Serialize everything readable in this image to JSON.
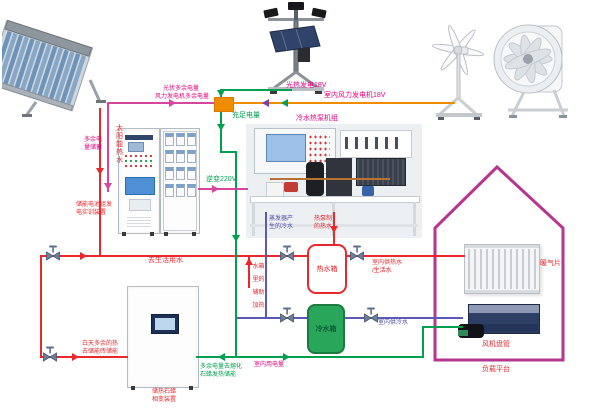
{
  "colors": {
    "pipe_hot": "#e8282d",
    "pipe_cold": "#5a5ab4",
    "wire_green": "#00a050",
    "wire_orange": "#f08c00",
    "wire_magenta": "#d6459e",
    "house_outline": "#b5358f",
    "tank_cold_fill": "#2aa65a"
  },
  "labels": {
    "solar_hot_water": "太阳能热水",
    "pv_generation": "光热发电18V",
    "indoor_wind_generation": "室内风力发电机18V",
    "pv_surplus": "光伏多余电量",
    "wind_surplus": "风力发电机多余电量",
    "surplus_storage": [
      "多余电",
      "量储蓄"
    ],
    "sufficient_power": "充足电量",
    "inverter_220v": "逆变220V",
    "battery_training_device": [
      "储能电池组发",
      "电实训装置"
    ],
    "heat_pump_unit": "冷水热泵机组",
    "evaporator_cold_water": [
      "蒸发器产",
      "生的冷水"
    ],
    "heat_pump_hot_water": [
      "热泵制",
      "的热水"
    ],
    "hot_water_tank": "热水箱",
    "cold_water_tank": "冷水箱",
    "to_domestic_water": "去生活用水",
    "indoor_hot_water": [
      "室内供热水",
      "/生活水"
    ],
    "indoor_cold_water": "室内供冷水",
    "tank_aux_heating": [
      "水箱",
      "里的",
      "辅助",
      "加热"
    ],
    "daytime_surplus_heat": [
      "白天多余的热",
      "去储能砖储能"
    ],
    "paraffin_device": [
      "储热石蜡",
      "相变装置"
    ],
    "surplus_to_melt": [
      "多余电量去熔化",
      "石蜡发热储能"
    ],
    "indoor_power_use": "室内用电量",
    "radiator": "暖气片",
    "fan_coil": "风机盘管",
    "load_platform": "负载平台"
  }
}
